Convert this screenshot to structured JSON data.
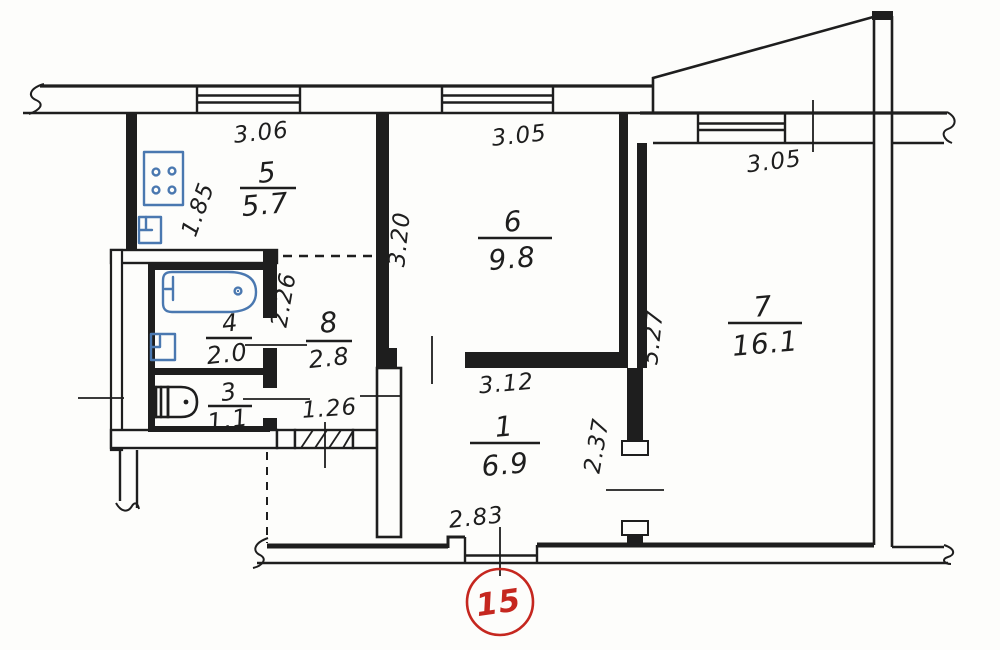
{
  "plan": {
    "title": "apartment-floor-plan",
    "sheet": {
      "number": "15"
    },
    "rooms": {
      "r5": {
        "number": "5",
        "area": "5.7"
      },
      "r6": {
        "number": "6",
        "area": "9.8"
      },
      "r7": {
        "number": "7",
        "area": "16.1"
      },
      "r4": {
        "number": "4",
        "area": "2.0"
      },
      "r8": {
        "number": "8",
        "area": "2.8"
      },
      "r3": {
        "number": "3",
        "area": "1.1"
      },
      "r1": {
        "number": "1",
        "area": "6.9"
      }
    },
    "dimensions": {
      "kitchen_width": "3.06",
      "kitchen_depth": "1.85",
      "room6_width": "3.05",
      "room6_depth": "3.20",
      "room7_window": "3.05",
      "room7_depth": "5.27",
      "hall_depth": "2.26",
      "hall_width": "1.26",
      "room1_width": "3.12",
      "room1_depth": "2.37",
      "balcony_door_width": "2.83"
    },
    "colors": {
      "line": "#1e1e1e",
      "fixture_blue": "#4a78b0",
      "accent_red": "#c5271f",
      "background": "#fdfdfb"
    }
  }
}
